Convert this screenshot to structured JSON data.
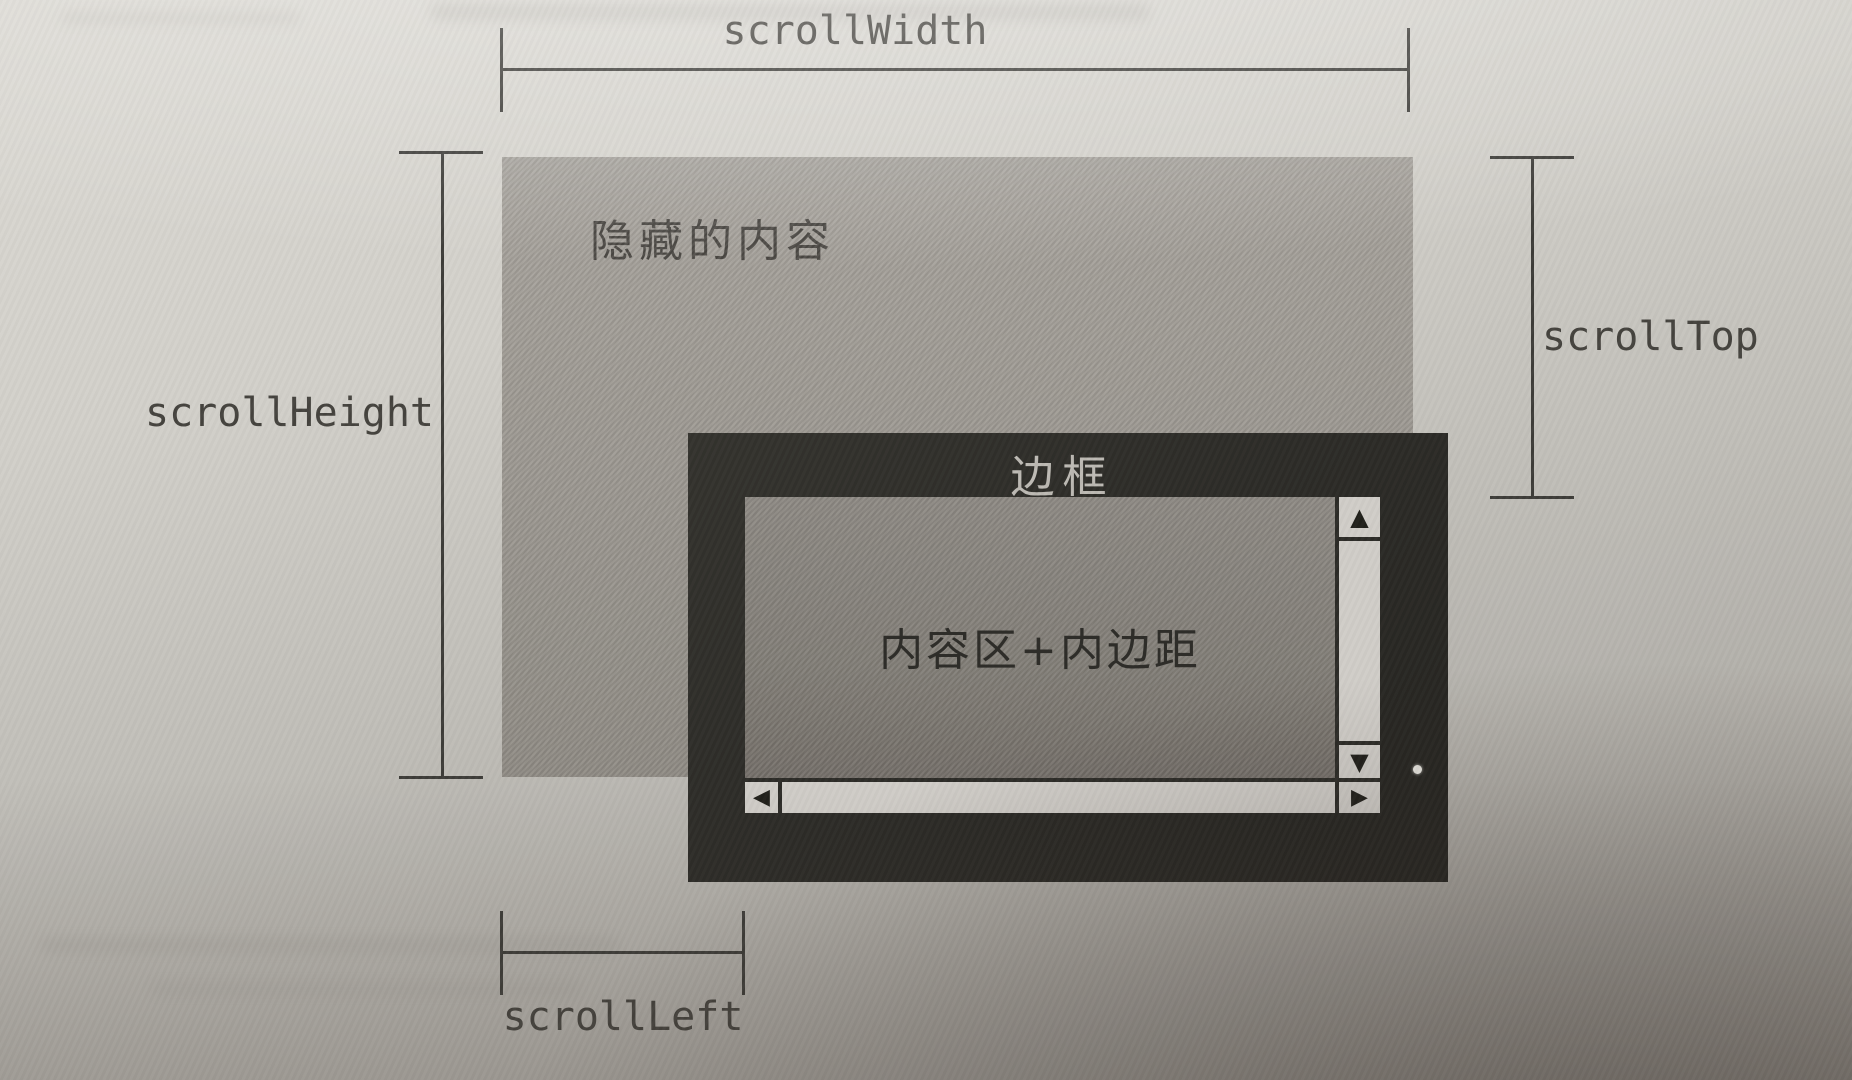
{
  "figure": {
    "measurements": {
      "scroll_width": {
        "label": "scrollWidth"
      },
      "scroll_height": {
        "label": "scrollHeight"
      },
      "scroll_top": {
        "label": "scrollTop"
      },
      "scroll_left": {
        "label": "scrollLeft"
      }
    },
    "scroll_content": {
      "hidden_label": "隐藏的内容"
    },
    "viewport": {
      "border_label": "边框",
      "content_label": "内容区+内边距",
      "scrollbars": {
        "up_arrow": "▲",
        "down_arrow": "▼",
        "left_arrow": "◀",
        "right_arrow": "▶"
      }
    },
    "colors": {
      "line": "#3e3d39",
      "label_text": "#45433e",
      "content_fill": "#9b9790",
      "content_text": "#4a4742",
      "viewport_border": "#2d2c28",
      "viewport_border_label": "#bdbab4",
      "viewport_fill": "#837f79",
      "viewport_text": "#2e2d29",
      "scrollbar_fill": "#d0cdc8",
      "arrow_color": "#21201b",
      "page_top": "#dcdad4",
      "page_bottom": "#9e9a94"
    }
  }
}
